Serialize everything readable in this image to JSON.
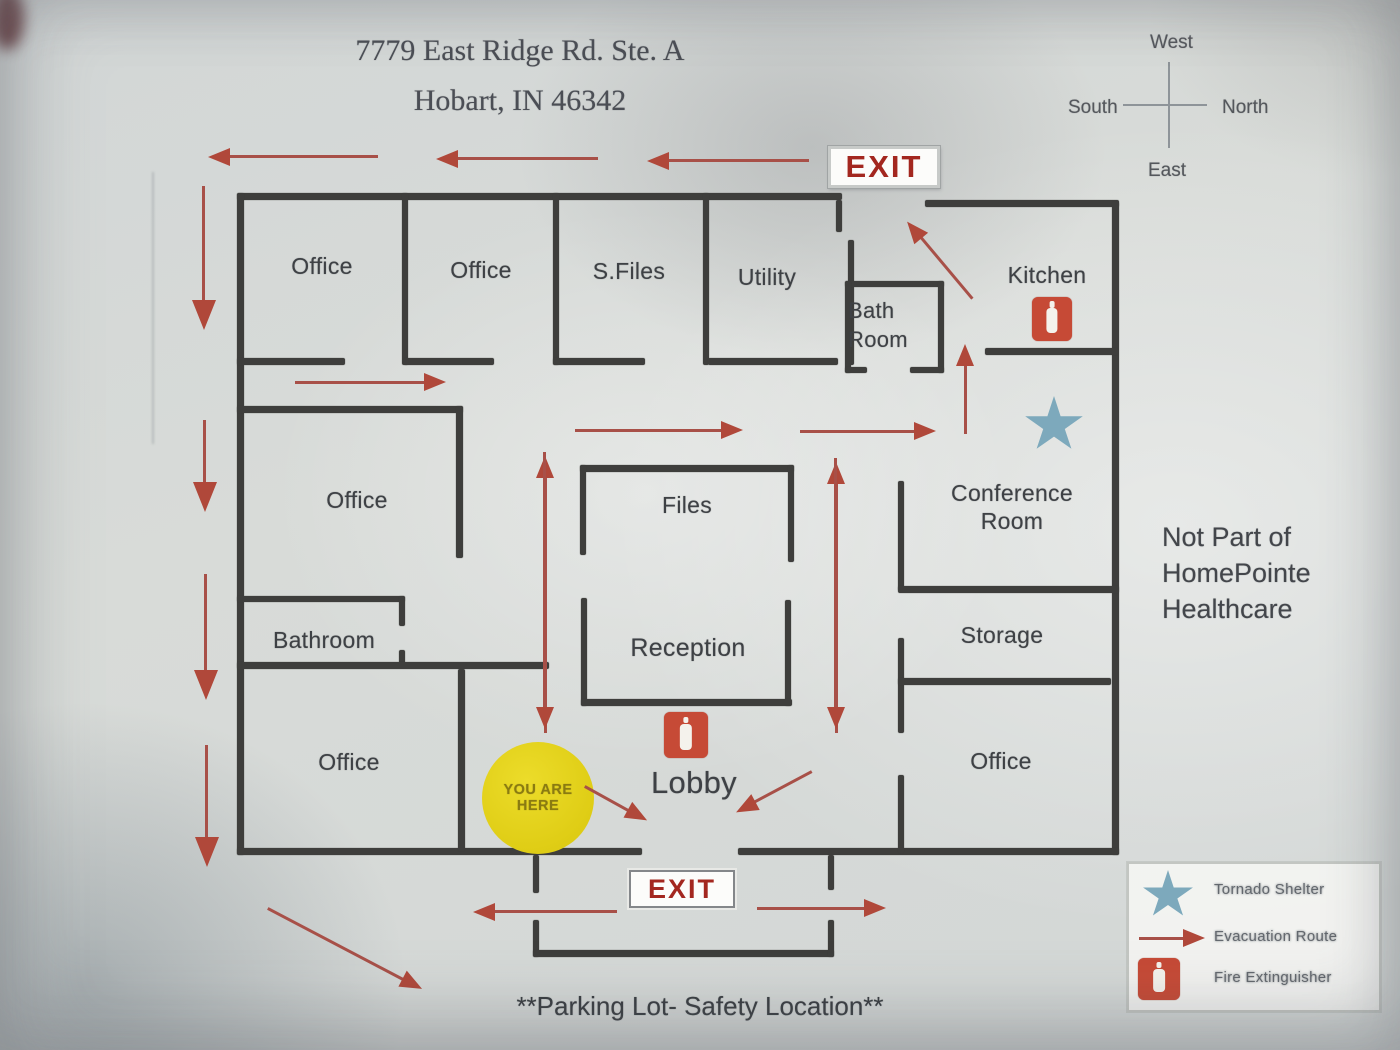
{
  "address": {
    "line1": "7779 East Ridge Rd. Ste. A",
    "line2": "Hobart, IN 46342"
  },
  "compass": {
    "top": "West",
    "left": "South",
    "right": "North",
    "bottom": "East"
  },
  "exits": {
    "top": "EXIT",
    "bottom": "EXIT"
  },
  "rooms": {
    "office_top_1": "Office",
    "office_top_2": "Office",
    "s_files": "S.Files",
    "utility": "Utility",
    "bath_room_line1": "Bath",
    "bath_room_line2": "Room",
    "kitchen": "Kitchen",
    "office_mid_left": "Office",
    "files": "Files",
    "conference_line1": "Conference",
    "conference_line2": "Room",
    "bathroom": "Bathroom",
    "reception": "Reception",
    "storage": "Storage",
    "office_bottom_left": "Office",
    "lobby": "Lobby",
    "office_bottom_right": "Office"
  },
  "marker": {
    "line1": "YOU ARE",
    "line2": "HERE"
  },
  "notes": {
    "not_part_line1": "Not Part of",
    "not_part_line2": "HomePointe",
    "not_part_line3": "Healthcare",
    "parking": "**Parking Lot- Safety Location**"
  },
  "legend": {
    "tornado": "Tornado Shelter",
    "evacuation": "Evacuation Route",
    "fire": "Fire Extinguisher"
  },
  "colors": {
    "wall": "#3e3e3c",
    "evacuation_route": "#b0483a",
    "exit_text": "#a3271f",
    "marker_bg": "#e0cf1d",
    "tornado_star": "#7da9bc",
    "fire_extinguisher": "#c64a36"
  }
}
